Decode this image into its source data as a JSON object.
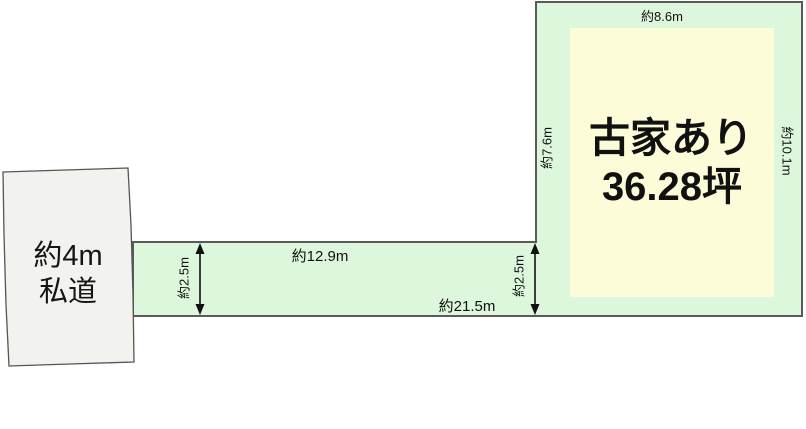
{
  "diagram": {
    "title": "land-parcel-floor-plan",
    "road": {
      "label_line1": "約4m",
      "label_line2": "私道"
    },
    "parcel": {
      "building_note": "古家あり",
      "area_value": "36.28坪",
      "dim_top": "約8.6m",
      "dim_left": "約7.6m",
      "dim_right": "約10.1m",
      "dim_strip_top": "約12.9m",
      "dim_strip_bottom": "約21.5m",
      "dim_strip_width_left": "約2.5m",
      "dim_strip_width_right": "約2.5m"
    },
    "colors": {
      "land_fill": "#ddf7dc",
      "inner_fill": "#fdfcd8",
      "road_fill": "#f2f2ef",
      "note_red": "#d32b22",
      "area_blue": "#2334cc",
      "line_dark": "#111111",
      "edge_gray": "#5a5a5a"
    }
  }
}
